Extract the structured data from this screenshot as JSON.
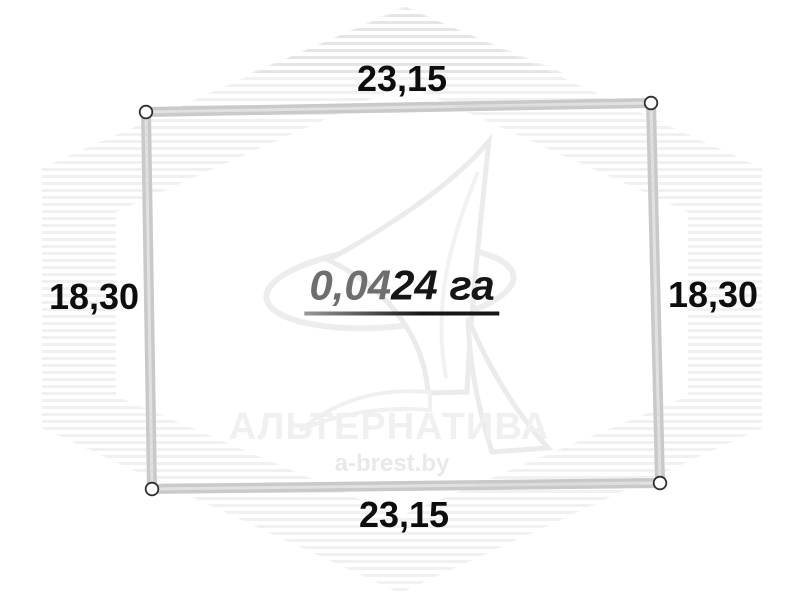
{
  "diagram": {
    "dimensions": {
      "top": "23,15",
      "bottom": "23,15",
      "left": "18,30",
      "right": "18,30"
    },
    "area": {
      "full": "0,0424 га",
      "prefix": "0,04",
      "suffix": "24 га"
    },
    "corner_markers": {
      "shape": "circle",
      "count": 4
    }
  },
  "watermark": {
    "brand": "АЛЬТЕРНАТИВА",
    "site": "a-brest.by"
  },
  "colors": {
    "border": "#c9c9c9",
    "border_highlight": "#e1e1e1",
    "label_text": "#0d0d0d",
    "area_prefix": "#6e6e6e",
    "area_suffix": "#161616",
    "watermark_text": "#f0f0f0"
  }
}
